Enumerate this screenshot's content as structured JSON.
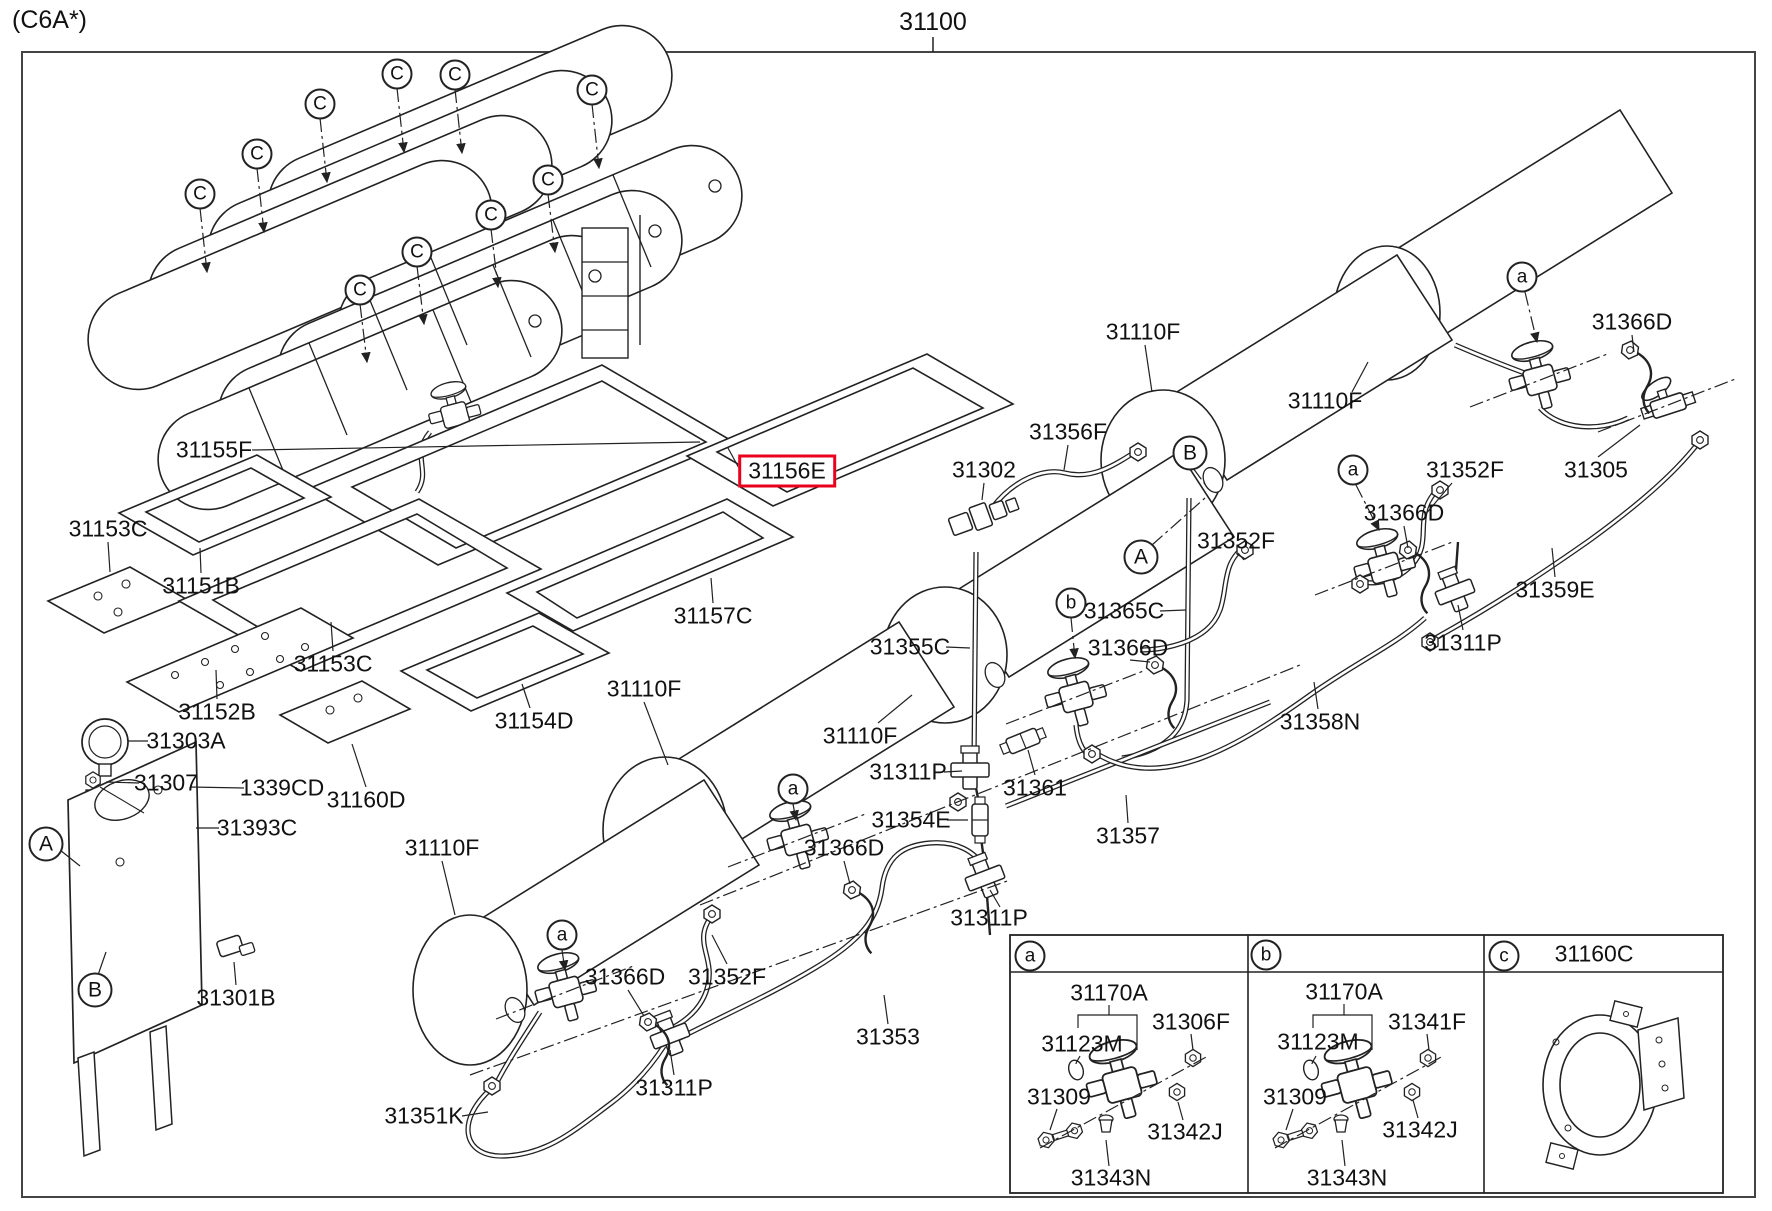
{
  "page": {
    "variant_code": "(C6A*)",
    "assembly_number": "31100"
  },
  "highlight": {
    "part": "31156E",
    "box_color": "#e8001c"
  },
  "labels": [
    {
      "text": "31155F",
      "x": 214,
      "y": 450
    },
    {
      "text": "31153C",
      "x": 108,
      "y": 529
    },
    {
      "text": "31151B",
      "x": 201,
      "y": 586
    },
    {
      "text": "31153C",
      "x": 333,
      "y": 664
    },
    {
      "text": "31152B",
      "x": 217,
      "y": 712
    },
    {
      "text": "31303A",
      "x": 186,
      "y": 741
    },
    {
      "text": "31307",
      "x": 166,
      "y": 783
    },
    {
      "text": "1339CD",
      "x": 282,
      "y": 788
    },
    {
      "text": "31160D",
      "x": 366,
      "y": 800
    },
    {
      "text": "31393C",
      "x": 257,
      "y": 828
    },
    {
      "text": "31301B",
      "x": 236,
      "y": 998
    },
    {
      "text": "31154D",
      "x": 534,
      "y": 721
    },
    {
      "text": "31157C",
      "x": 713,
      "y": 616
    },
    {
      "text": "31156E",
      "x": 787,
      "y": 471,
      "hl": true
    },
    {
      "text": "31110F",
      "x": 644,
      "y": 689
    },
    {
      "text": "31110F",
      "x": 860,
      "y": 736
    },
    {
      "text": "31110F",
      "x": 442,
      "y": 848
    },
    {
      "text": "31110F",
      "x": 1143,
      "y": 332
    },
    {
      "text": "31110F",
      "x": 1325,
      "y": 401
    },
    {
      "text": "31356F",
      "x": 1068,
      "y": 432
    },
    {
      "text": "31302",
      "x": 984,
      "y": 470
    },
    {
      "text": "31355C",
      "x": 910,
      "y": 647
    },
    {
      "text": "31365C",
      "x": 1124,
      "y": 611
    },
    {
      "text": "31366D",
      "x": 1632,
      "y": 322
    },
    {
      "text": "31366D",
      "x": 1404,
      "y": 513
    },
    {
      "text": "31366D",
      "x": 1128,
      "y": 648
    },
    {
      "text": "31366D",
      "x": 844,
      "y": 848
    },
    {
      "text": "31366D",
      "x": 625,
      "y": 977
    },
    {
      "text": "31352F",
      "x": 1465,
      "y": 470
    },
    {
      "text": "31352F",
      "x": 1236,
      "y": 541
    },
    {
      "text": "31352F",
      "x": 727,
      "y": 977
    },
    {
      "text": "31305",
      "x": 1596,
      "y": 470
    },
    {
      "text": "31359E",
      "x": 1555,
      "y": 590
    },
    {
      "text": "31358N",
      "x": 1320,
      "y": 722
    },
    {
      "text": "31311P",
      "x": 908,
      "y": 772
    },
    {
      "text": "31311P",
      "x": 1463,
      "y": 643
    },
    {
      "text": "31311P",
      "x": 989,
      "y": 918
    },
    {
      "text": "31311P",
      "x": 674,
      "y": 1088
    },
    {
      "text": "31361",
      "x": 1035,
      "y": 788
    },
    {
      "text": "31357",
      "x": 1128,
      "y": 836
    },
    {
      "text": "31354E",
      "x": 911,
      "y": 820
    },
    {
      "text": "31353",
      "x": 888,
      "y": 1037
    },
    {
      "text": "31351K",
      "x": 424,
      "y": 1116
    },
    {
      "text": "31170A",
      "x": 1109,
      "y": 993
    },
    {
      "text": "31123M",
      "x": 1082,
      "y": 1044
    },
    {
      "text": "31306F",
      "x": 1191,
      "y": 1022
    },
    {
      "text": "31309",
      "x": 1059,
      "y": 1097
    },
    {
      "text": "31342J",
      "x": 1185,
      "y": 1132
    },
    {
      "text": "31343N",
      "x": 1111,
      "y": 1178
    },
    {
      "text": "31170A",
      "x": 1344,
      "y": 992
    },
    {
      "text": "31123M",
      "x": 1318,
      "y": 1042
    },
    {
      "text": "31341F",
      "x": 1427,
      "y": 1022
    },
    {
      "text": "31309",
      "x": 1295,
      "y": 1097
    },
    {
      "text": "31342J",
      "x": 1420,
      "y": 1130
    },
    {
      "text": "31343N",
      "x": 1347,
      "y": 1178
    },
    {
      "text": "31160C",
      "x": 1594,
      "y": 954
    }
  ],
  "callouts": [
    {
      "letter": "C",
      "x": 200,
      "y": 194,
      "size": "md"
    },
    {
      "letter": "C",
      "x": 257,
      "y": 154,
      "size": "md"
    },
    {
      "letter": "C",
      "x": 320,
      "y": 104,
      "size": "md"
    },
    {
      "letter": "C",
      "x": 397,
      "y": 74,
      "size": "md"
    },
    {
      "letter": "C",
      "x": 455,
      "y": 75,
      "size": "md"
    },
    {
      "letter": "C",
      "x": 592,
      "y": 90,
      "size": "md"
    },
    {
      "letter": "C",
      "x": 548,
      "y": 180,
      "size": "md"
    },
    {
      "letter": "C",
      "x": 491,
      "y": 215,
      "size": "md"
    },
    {
      "letter": "C",
      "x": 417,
      "y": 252,
      "size": "md"
    },
    {
      "letter": "C",
      "x": 360,
      "y": 290,
      "size": "md"
    },
    {
      "letter": "A",
      "x": 46,
      "y": 844,
      "size": "lg"
    },
    {
      "letter": "B",
      "x": 95,
      "y": 990,
      "size": "lg"
    },
    {
      "letter": "B",
      "x": 1190,
      "y": 453,
      "size": "lg"
    },
    {
      "letter": "A",
      "x": 1141,
      "y": 557,
      "size": "lg"
    },
    {
      "letter": "a",
      "x": 562,
      "y": 935,
      "size": "md"
    },
    {
      "letter": "a",
      "x": 793,
      "y": 789,
      "size": "md"
    },
    {
      "letter": "a",
      "x": 1353,
      "y": 470,
      "size": "md"
    },
    {
      "letter": "a",
      "x": 1522,
      "y": 277,
      "size": "md"
    },
    {
      "letter": "b",
      "x": 1071,
      "y": 603,
      "size": "md"
    },
    {
      "letter": "a",
      "x": 1030,
      "y": 956,
      "size": "md"
    },
    {
      "letter": "b",
      "x": 1266,
      "y": 955,
      "size": "md"
    },
    {
      "letter": "c",
      "x": 1504,
      "y": 956,
      "size": "md"
    }
  ],
  "inset": {
    "panel_letters": [
      "a",
      "b",
      "c"
    ],
    "panel_c_part": "31160C"
  }
}
